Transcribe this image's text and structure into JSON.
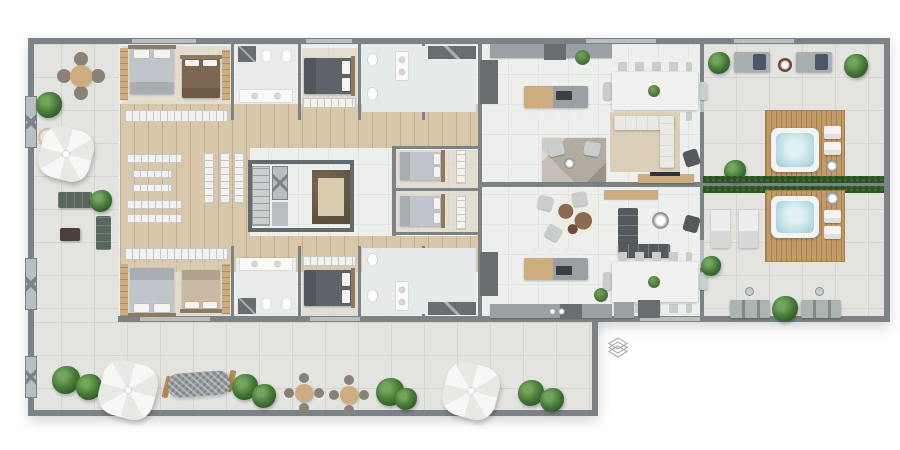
{
  "palette": {
    "pageBg": "#ffffff",
    "terraceTile": "#e3e4e0",
    "terraceGrout": "#d4d5d1",
    "interiorTile": "#eef0ee",
    "interiorGrout": "#e1e4e2",
    "wood": "#d9c7ab",
    "woodLine": "#c3ad8d",
    "woodTable": "#cdad7f",
    "deck": "#c29b69",
    "deckLine": "#a67f4e",
    "wallGrey": "#7d8286",
    "wallDark": "#64696d",
    "winGlass": "#b9bfc1",
    "plantA": "#477b39",
    "plantB": "#2d5626",
    "plantLight": "#74a55c",
    "hedgeA": "#3e6b30",
    "hedgeB": "#2c5123",
    "parasolA": "#f7f8f6",
    "parasolB": "#e8e9e5",
    "chairDark": "#8a8177",
    "chairGrey": "#c9cecd",
    "stoolWhite": "#ececea",
    "shelfWhite": "#f2f2ef",
    "shelfLine": "#c8c8c2",
    "headboard": "#8d7a60",
    "pillow": "#f4f5f3",
    "bedLight": "#bfc5ca",
    "bedBrown": "#7b6751",
    "bedBeige": "#cbb9a4",
    "bedDark": "#5e646a",
    "sofaWhite": "#e9eae6",
    "sofaDark": "#54595d",
    "sofaGreen": "#57675c",
    "rugTaupe": "#b3aaa0",
    "rugBeige": "#dbcfba",
    "cowBrown": "#8a6b4f",
    "tableWhite": "#f1f2f0",
    "counterGrey": "#9aa0a3",
    "applianceDark": "#686d70",
    "water": "#b9dee3",
    "tubShell": "#f3f5f4",
    "stairBg": "#cdd0d2",
    "stairLine": "#9aa0a2",
    "marbleDark": "#5d4f40",
    "marbleRug": "#d8cbae",
    "loungerPad": "#a9aeb0",
    "cushionDark": "#4b5864",
    "benchGrey": "#7f8c86",
    "hammockGrey": "#939a9e",
    "hammockWood": "#b08a52",
    "logoGrey": "#9aa0a4"
  },
  "icons": {
    "watermark_logo": "layered-diamond"
  }
}
